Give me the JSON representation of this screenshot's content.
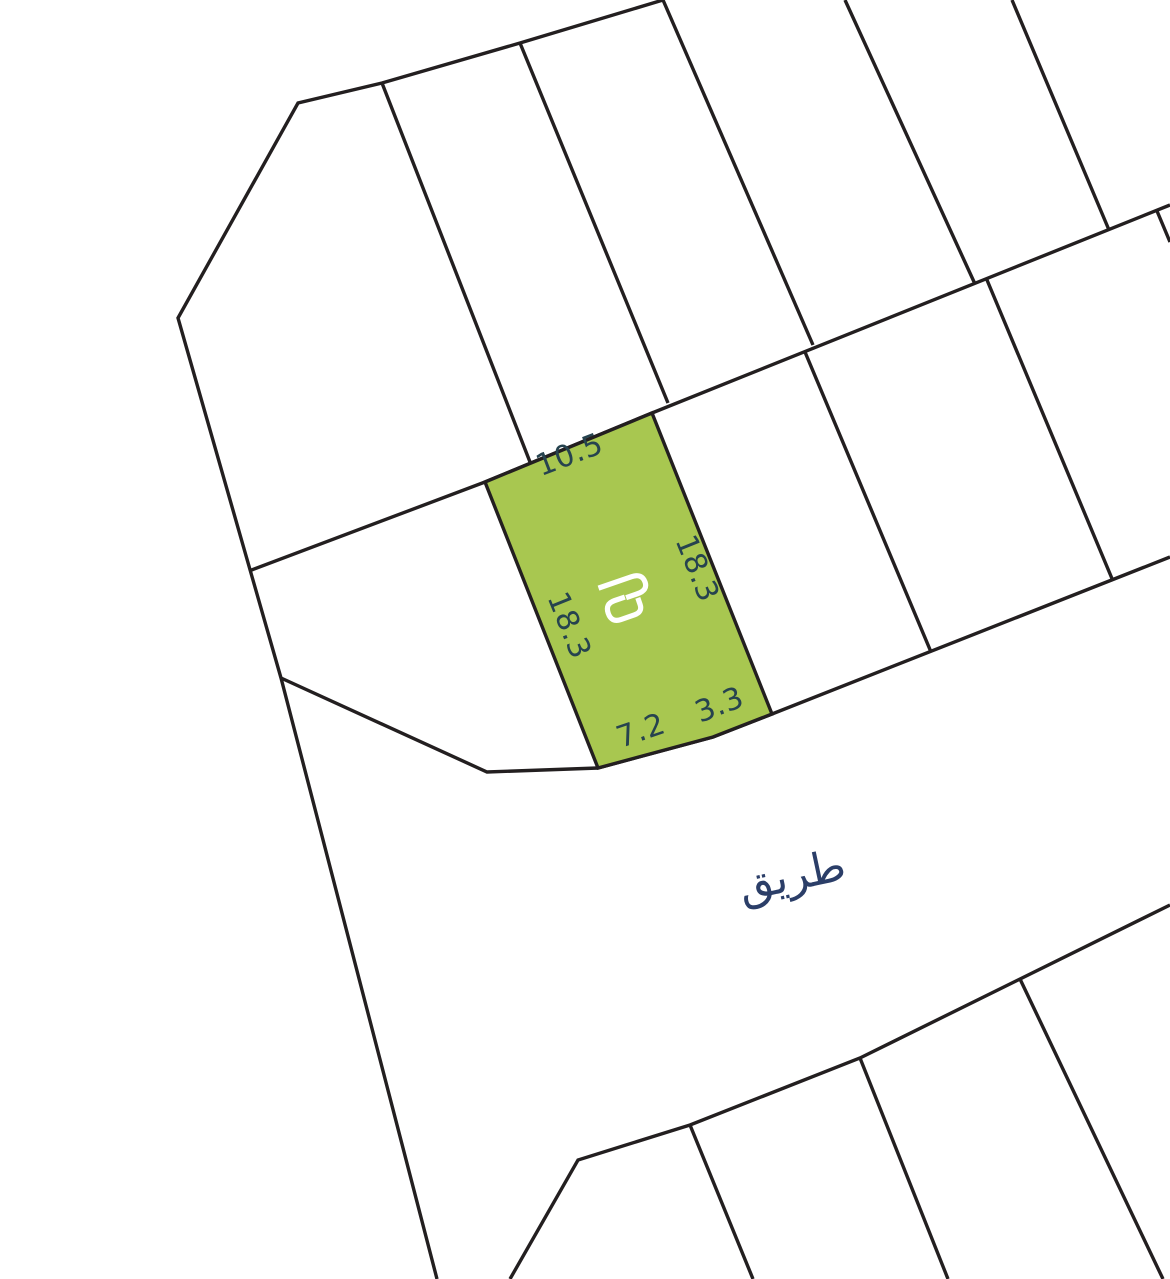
{
  "map": {
    "background": "#ffffff",
    "line_color": "#231f20",
    "road_label": {
      "text": "طريق",
      "color": "#2b3e68"
    },
    "highlight_parcel": {
      "fill": "#a8c750",
      "dimension_color": "#26434f",
      "dimensions": {
        "top": "10.5",
        "right": "18.3",
        "left": "18.3",
        "bottom_left": "7.2",
        "bottom_right": "3.3"
      },
      "logo": {
        "color": "#ffffff",
        "hook_top_d": "M -25,-18 H 10 Q 21,-18 21,-8.5 Q 21,0 10,0 H -2",
        "hook_bottom_d": "M -3,-1 H -14 Q -24,-1 -24,9 Q -24,19 -14,19 H 0 Q 9,19 9,11 L 9,4"
      }
    },
    "geometry": {
      "outer_chain": "663,0 520,43 382,83 298,103 178,318 281,678 437,1279",
      "row1_boundary": "249,571 485,482 652,413 1170,205",
      "rowA_divider1": "382,83 530,462",
      "rowA_divider2": "520,43 668,403",
      "rowA_divider3": "663,0 813,345",
      "rowA_divider4": "845,0 975,284",
      "rowA_divider5": "1012,0 1109,230",
      "highlight_polygon": "485,482 652,413 772,714 713,737 598,768",
      "rowB_divider2": "805,352 931,652",
      "rowB_divider3": "987,280 1113,581",
      "rowB_divider4": "1157,211 1170,242",
      "road_top": "281,678 487,772 598,768 713,737 772,714 1170,557",
      "road_bottom": "510,1279 578,1160 690,1125 860,1058 1170,905",
      "rowC_divider1": "690,1125 753,1279",
      "rowC_divider2": "860,1058 948,1279",
      "rowC_divider3": "1020,979 1163,1279"
    }
  }
}
